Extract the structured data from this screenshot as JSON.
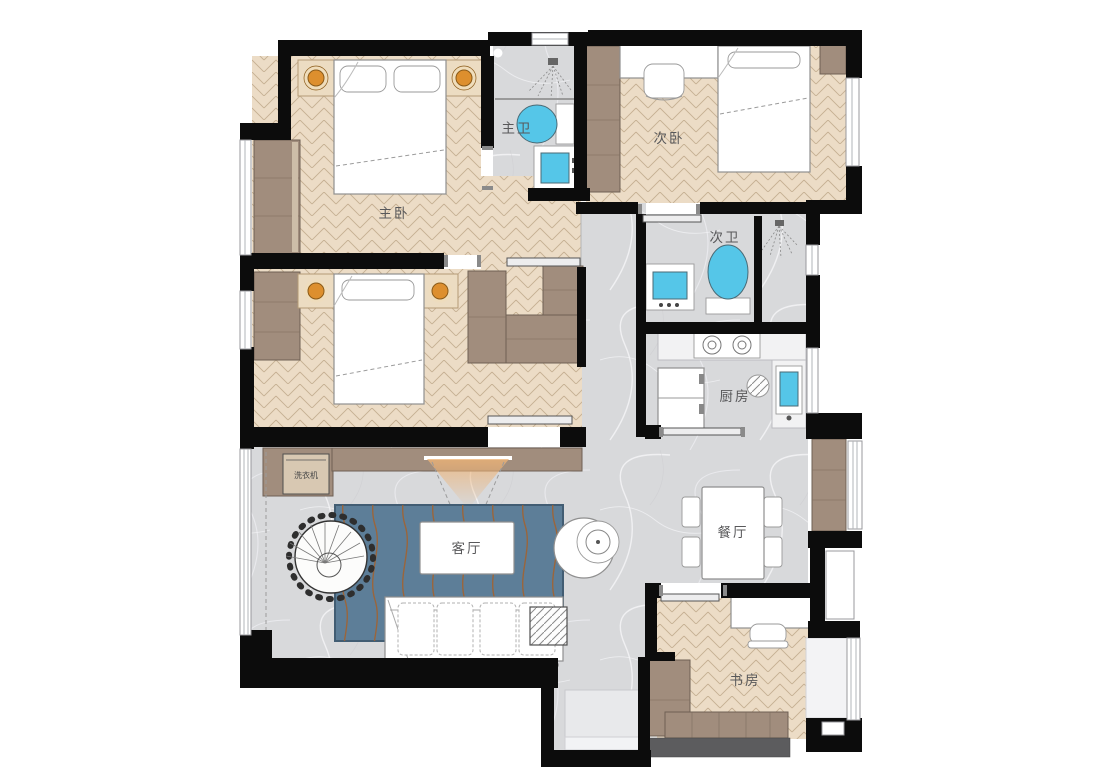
{
  "plan": {
    "rooms": {
      "master_bedroom": "主卧",
      "master_bath": "主卫",
      "second_bedroom": "次卧",
      "second_bath": "次卫",
      "kitchen": "厨房",
      "living_room": "客厅",
      "dining_room": "餐厅",
      "study": "书房"
    },
    "appliances": {
      "washing_machine": "洗衣机"
    }
  },
  "colors": {
    "wall": "#0c0c0c",
    "wood_floor": "#ecdcc6",
    "wood_line": "#b29878",
    "marble_floor": "#d8d9db",
    "cabinet_wood": "#a18d7d",
    "rug_blue": "#5d7e98",
    "rug_wave_orange": "#a5602a",
    "fixture_blue": "#55c6e8",
    "lamp_orange": "#dd8f2e",
    "beam_orange": "#edb377",
    "furniture_white": "#ffffff"
  }
}
